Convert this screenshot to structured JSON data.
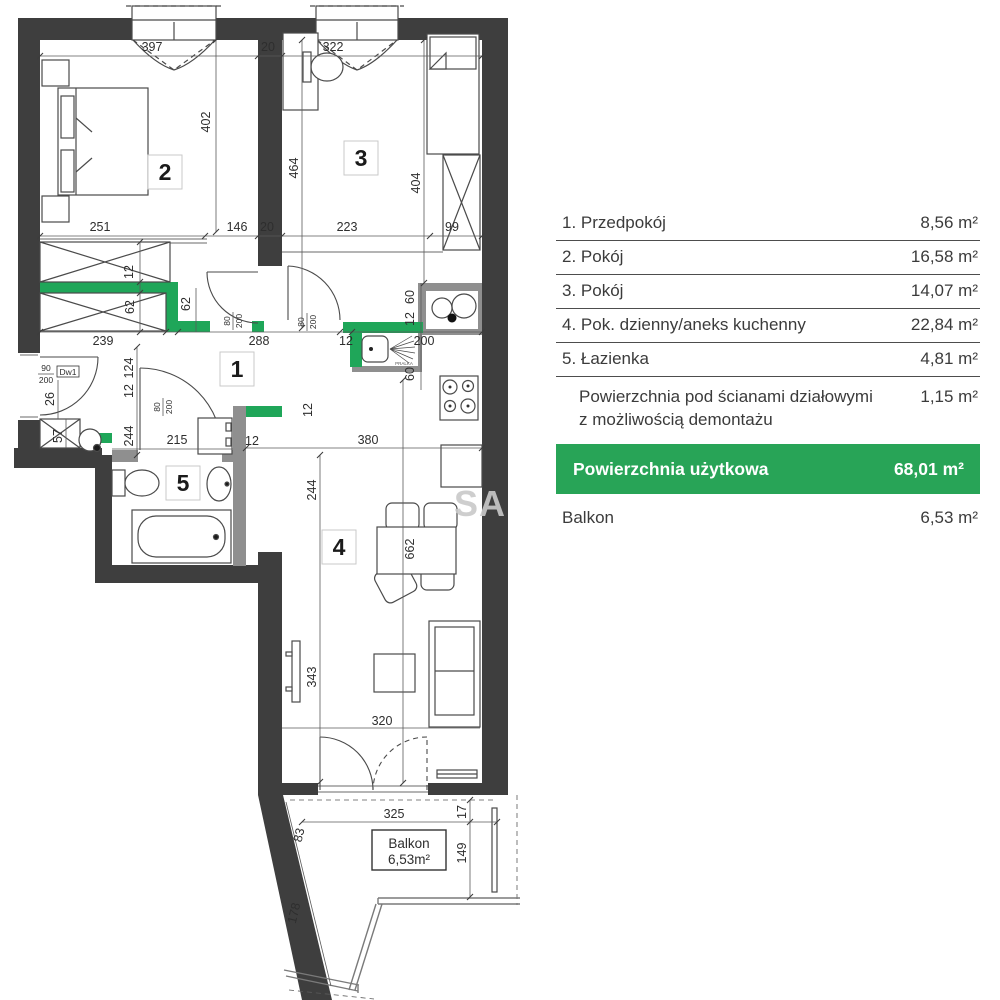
{
  "legend": {
    "rows": [
      {
        "label": "1. Przedpokój",
        "value": "8,56 m²"
      },
      {
        "label": "2. Pokój",
        "value": "16,58 m²"
      },
      {
        "label": "3. Pokój",
        "value": "14,07 m²"
      },
      {
        "label": "4. Pok. dzienny/aneks kuchenny",
        "value": "22,84 m²"
      },
      {
        "label": "5. Łazienka",
        "value": "4,81 m²"
      }
    ],
    "partition_row": {
      "label_line1": "Powierzchnia pod ścianami działowymi",
      "label_line2": "z możliwością  demontażu",
      "value": "1,15 m²"
    },
    "total_row": {
      "label": "Powierzchnia użytkowa",
      "value": "68,01 m²"
    },
    "balcony_row": {
      "label": "Balkon",
      "value": "6,53 m²"
    },
    "accent_color": "#28a457"
  },
  "plan": {
    "room_numbers": {
      "hall": "1",
      "bedroom": "2",
      "room3": "3",
      "living": "4",
      "bathroom": "5"
    },
    "balcony_box": {
      "line1": "Balkon",
      "line2": "6,53m²"
    },
    "watermark": "SA",
    "appliance_label": "PRALKA",
    "colors": {
      "demountable_wall_green": "#1fa659",
      "structural_wall": "#3e3e3e"
    },
    "entrance_door": {
      "width": "90",
      "height": "200",
      "code": "Dw1"
    },
    "door": {
      "width": "80",
      "height": "200"
    },
    "dims": {
      "top_w1": "397",
      "top_wall": "20",
      "top_w2": "322",
      "r2_h": "402",
      "r2_w": "251",
      "r2_b": "146",
      "r2_b2": "20",
      "r3_hl": "464",
      "r3_hr": "404",
      "r3_w": "223",
      "r3_ward": "99",
      "c_12": "12",
      "c_62a": "62",
      "c_62b": "62",
      "c_239": "239",
      "c_288": "288",
      "k_12a": "12",
      "k_200": "200",
      "k_60a": "60",
      "k_12b": "12",
      "k_60b": "60",
      "k_12c": "12",
      "k_380": "380",
      "h_12w": "12",
      "h_124": "124",
      "h_12": "12",
      "h_244": "244",
      "h_215": "215",
      "e_26": "26",
      "e_57": "57",
      "l_244": "244",
      "l_662": "662",
      "l_343": "343",
      "l_320": "320",
      "b_325": "325",
      "b_17": "17",
      "b_83": "83",
      "b_149": "149",
      "b_178": "178"
    }
  }
}
